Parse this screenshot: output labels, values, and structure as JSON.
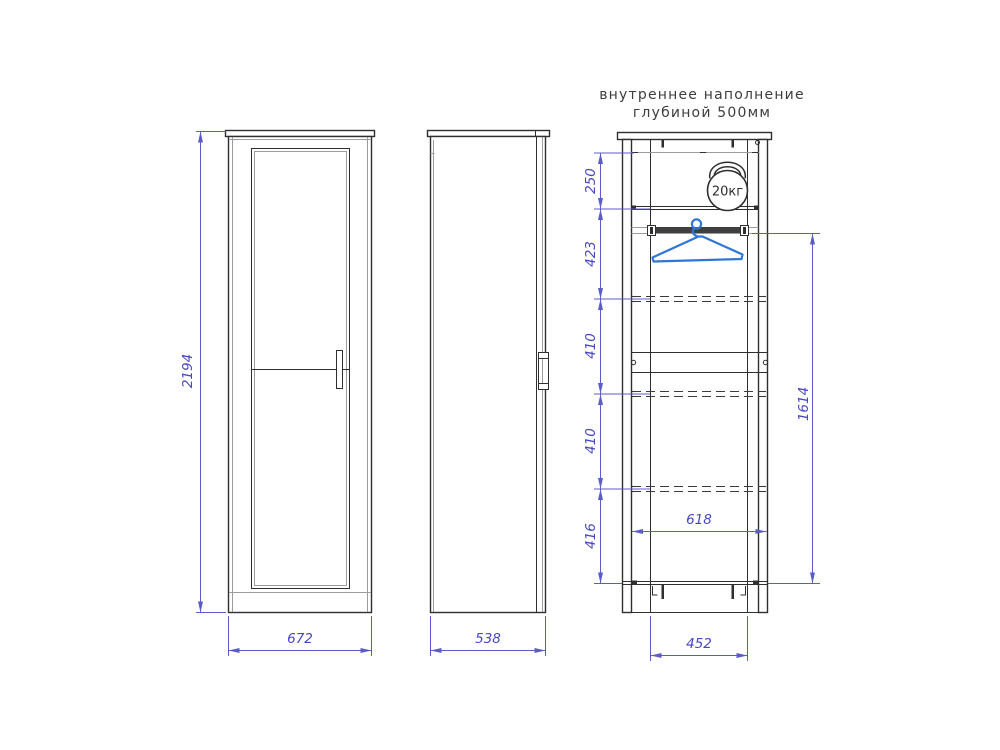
{
  "title": {
    "line1": "внутреннее наполнение",
    "line2": "глубиной 500мм"
  },
  "front_view": {
    "height_mm": "2194",
    "width_mm": "672"
  },
  "side_view": {
    "depth_mm": "538"
  },
  "internal_view": {
    "section_heights_mm": [
      "250",
      "423",
      "410",
      "410",
      "416"
    ],
    "rod_to_bottom_mm": "1614",
    "inner_width_mm": "618",
    "base_width_mm": "452",
    "max_load": "20кг"
  },
  "colors": {
    "outline": "#2f2f2f",
    "secondary": "#9b9ba1",
    "dimension": "#5c5cc9",
    "dimension_text": "#4747c2",
    "hanger_blue": "#2e76d8",
    "title_text": "#3d3d3d",
    "background": "#ffffff"
  }
}
